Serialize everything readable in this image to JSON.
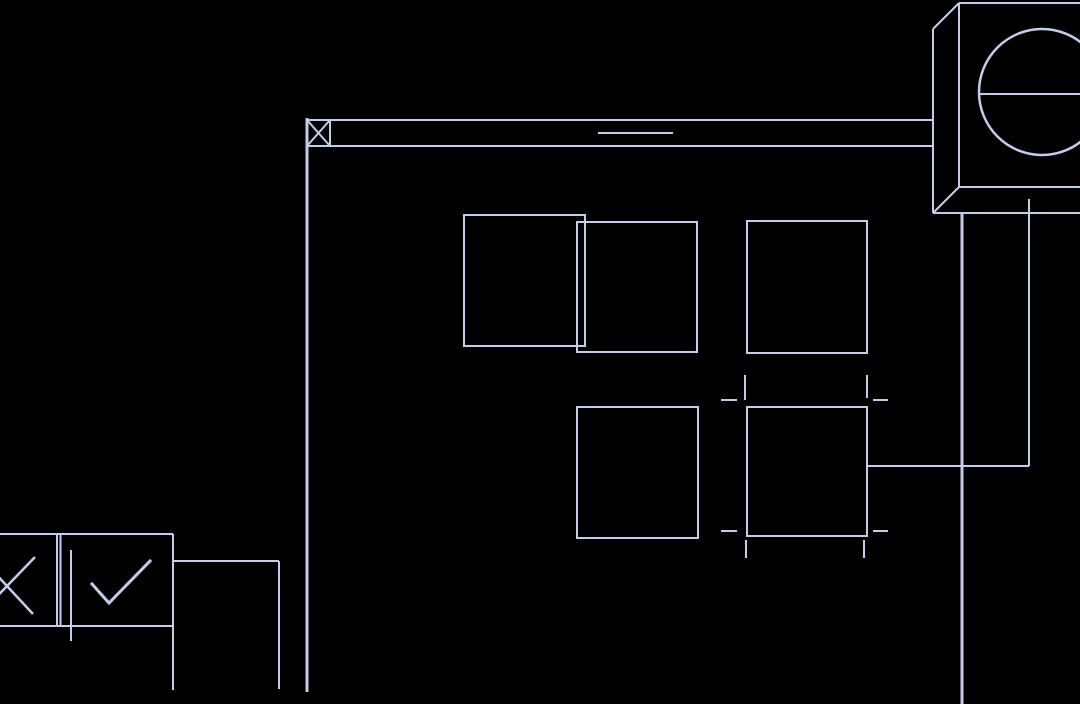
{
  "drawing": {
    "background_color": "#000000",
    "line_color": "#c3cce9",
    "default_stroke_width": 2,
    "segments": [
      {
        "id": "main-vertical-line",
        "x1": 307,
        "y1": 118,
        "x2": 307,
        "y2": 692,
        "sw": 3
      },
      {
        "id": "duct-top-line",
        "x1": 307,
        "y1": 120,
        "x2": 933,
        "y2": 120
      },
      {
        "id": "duct-bottom-line",
        "x1": 307,
        "y1": 146,
        "x2": 933,
        "y2": 146
      },
      {
        "id": "duct-break-dash",
        "x1": 598,
        "y1": 133,
        "x2": 673,
        "y2": 133
      },
      {
        "id": "anchor-box-right-edge",
        "x1": 330,
        "y1": 120,
        "x2": 330,
        "y2": 146
      },
      {
        "id": "anchor-box-x-stroke-1",
        "x1": 307,
        "y1": 120,
        "x2": 330,
        "y2": 146
      },
      {
        "id": "anchor-box-x-stroke-2",
        "x1": 307,
        "y1": 146,
        "x2": 330,
        "y2": 120
      },
      {
        "id": "unit-top-edge",
        "x1": 959,
        "y1": 3,
        "x2": 1084,
        "y2": 3
      },
      {
        "id": "unit-left-edge",
        "x1": 959,
        "y1": 3,
        "x2": 959,
        "y2": 187
      },
      {
        "id": "unit-bottom-edge",
        "x1": 959,
        "y1": 187,
        "x2": 1084,
        "y2": 187
      },
      {
        "id": "unit-top-corner-diagonal",
        "x1": 959,
        "y1": 3,
        "x2": 933,
        "y2": 29
      },
      {
        "id": "unit-back-left-edge",
        "x1": 933,
        "y1": 29,
        "x2": 933,
        "y2": 213
      },
      {
        "id": "unit-bottom-corner-diagonal",
        "x1": 959,
        "y1": 187,
        "x2": 933,
        "y2": 213
      },
      {
        "id": "unit-back-bottom-edge",
        "x1": 933,
        "y1": 213,
        "x2": 1084,
        "y2": 213
      },
      {
        "id": "dial-chord-line",
        "x1": 980,
        "y1": 94,
        "x2": 1084,
        "y2": 94
      },
      {
        "id": "right-riser-line",
        "x1": 962,
        "y1": 213,
        "x2": 962,
        "y2": 705,
        "sw": 3
      },
      {
        "id": "inner-riser-line",
        "x1": 1029,
        "y1": 199,
        "x2": 1029,
        "y2": 466
      },
      {
        "id": "riser-connector-line",
        "x1": 866,
        "y1": 466,
        "x2": 1029,
        "y2": 466
      },
      {
        "id": "mark-top-left-horizontal",
        "x1": 721,
        "y1": 400,
        "x2": 737,
        "y2": 400
      },
      {
        "id": "mark-top-left-vertical",
        "x1": 745,
        "y1": 375,
        "x2": 745,
        "y2": 400
      },
      {
        "id": "mark-top-right-horizontal",
        "x1": 873,
        "y1": 400,
        "x2": 888,
        "y2": 400
      },
      {
        "id": "mark-top-right-vertical",
        "x1": 867,
        "y1": 375,
        "x2": 867,
        "y2": 398
      },
      {
        "id": "mark-bottom-left-horizontal",
        "x1": 721,
        "y1": 531,
        "x2": 737,
        "y2": 531
      },
      {
        "id": "mark-bottom-left-vertical",
        "x1": 746,
        "y1": 540,
        "x2": 746,
        "y2": 558
      },
      {
        "id": "mark-bottom-right-horizontal",
        "x1": 873,
        "y1": 531,
        "x2": 888,
        "y2": 531
      },
      {
        "id": "mark-bottom-right-vertical",
        "x1": 864,
        "y1": 540,
        "x2": 864,
        "y2": 558
      },
      {
        "id": "legend-top-line",
        "x1": -8,
        "y1": 534,
        "x2": 173,
        "y2": 534
      },
      {
        "id": "legend-bottom-line",
        "x1": -8,
        "y1": 626,
        "x2": 174,
        "y2": 626
      },
      {
        "id": "legend-divider-line-1",
        "x1": 57,
        "y1": 534,
        "x2": 57,
        "y2": 626
      },
      {
        "id": "legend-divider-line-2",
        "x1": 60.5,
        "y1": 534,
        "x2": 60.5,
        "y2": 626
      },
      {
        "id": "legend-overlay-vertical",
        "x1": 71,
        "y1": 550,
        "x2": 71,
        "y2": 641
      },
      {
        "id": "legend-right-edge-line",
        "x1": 173,
        "y1": 534,
        "x2": 173,
        "y2": 690
      },
      {
        "id": "x-glyph-stroke-1",
        "x1": -20,
        "y1": 557,
        "x2": 33,
        "y2": 614,
        "sw": 2.5
      },
      {
        "id": "x-glyph-stroke-2",
        "x1": -20,
        "y1": 614,
        "x2": 35,
        "y2": 557,
        "sw": 2.5
      },
      {
        "id": "branch-horizontal-line",
        "x1": 173,
        "y1": 561,
        "x2": 279,
        "y2": 561
      },
      {
        "id": "branch-vertical-line",
        "x1": 279,
        "y1": 561,
        "x2": 279,
        "y2": 689
      }
    ],
    "rects": [
      {
        "id": "grid-square-1",
        "x": 464,
        "y": 215,
        "w": 121,
        "h": 131
      },
      {
        "id": "grid-square-2",
        "x": 577,
        "y": 222,
        "w": 120,
        "h": 130
      },
      {
        "id": "grid-square-3",
        "x": 747,
        "y": 221,
        "w": 120,
        "h": 132
      },
      {
        "id": "grid-square-4",
        "x": 577,
        "y": 407,
        "w": 121,
        "h": 131
      },
      {
        "id": "grid-square-5",
        "x": 747,
        "y": 407,
        "w": 120,
        "h": 129
      }
    ],
    "circles": [
      {
        "id": "dial-circle",
        "cx": 1042,
        "cy": 92,
        "r": 63,
        "sw": 2.5
      }
    ],
    "polylines": [
      {
        "id": "check-glyph",
        "points": "92,584 109,603 150,561",
        "sw": 3
      }
    ]
  }
}
